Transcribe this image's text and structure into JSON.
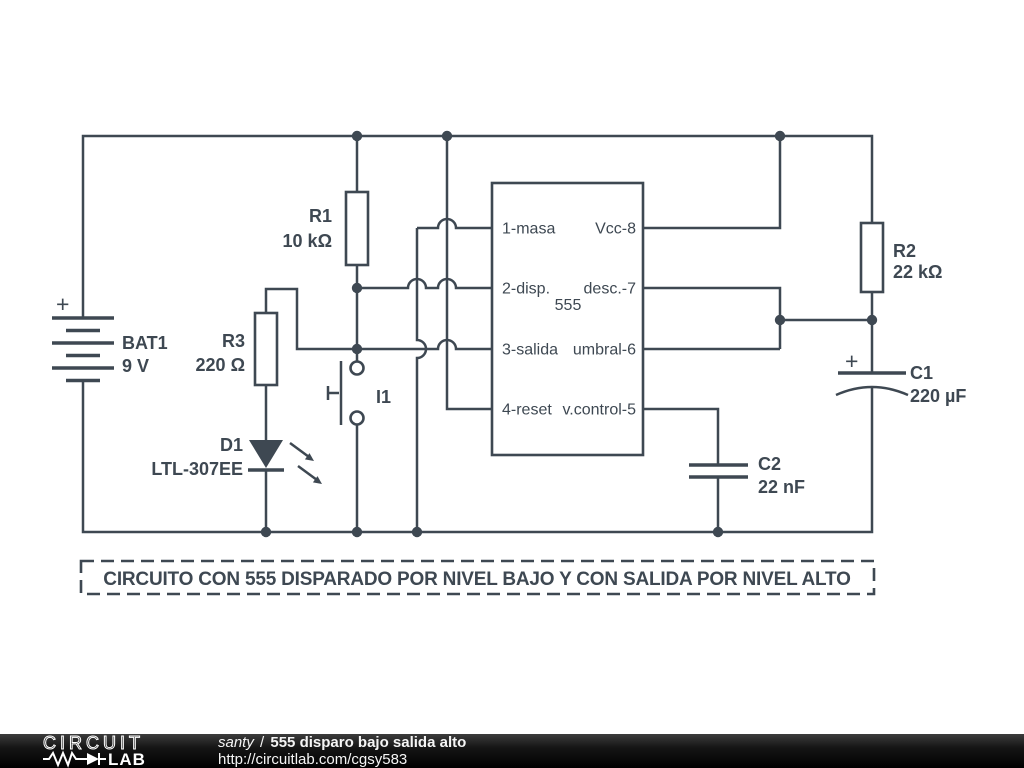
{
  "schematic": {
    "caption": "CIRCUITO CON 555 DISPARADO POR NIVEL BAJO Y CON SALIDA POR NIVEL ALTO",
    "components": {
      "bat1": {
        "ref": "BAT1",
        "value": "9 V",
        "plus": "+"
      },
      "r1": {
        "ref": "R1",
        "value": "10 kΩ"
      },
      "r2": {
        "ref": "R2",
        "value": "22 kΩ"
      },
      "r3": {
        "ref": "R3",
        "value": "220 Ω"
      },
      "c1": {
        "ref": "C1",
        "value": "220 µF",
        "plus": "+"
      },
      "c2": {
        "ref": "C2",
        "value": "22 nF"
      },
      "d1": {
        "ref": "D1",
        "value": "LTL-307EE"
      },
      "i1": {
        "ref": "I1"
      },
      "u555": {
        "label": "555",
        "pins_left": [
          "1-masa",
          "2-disp.",
          "3-salida",
          "4-reset"
        ],
        "pins_right": [
          "Vcc-8",
          "desc.-7",
          "umbral-6",
          "v.control-5"
        ]
      }
    }
  },
  "footer": {
    "logo_word": "CIRCUIT",
    "logo_word2": "LAB",
    "author": "santy",
    "divider": "/",
    "circuit_title": "555 disparo bajo salida alto",
    "url": "http://circuitlab.com/cgsy583"
  },
  "colors": {
    "ink": "#3e4852",
    "canvas": "#ffffff",
    "footer_text": "#f5f5f5"
  }
}
